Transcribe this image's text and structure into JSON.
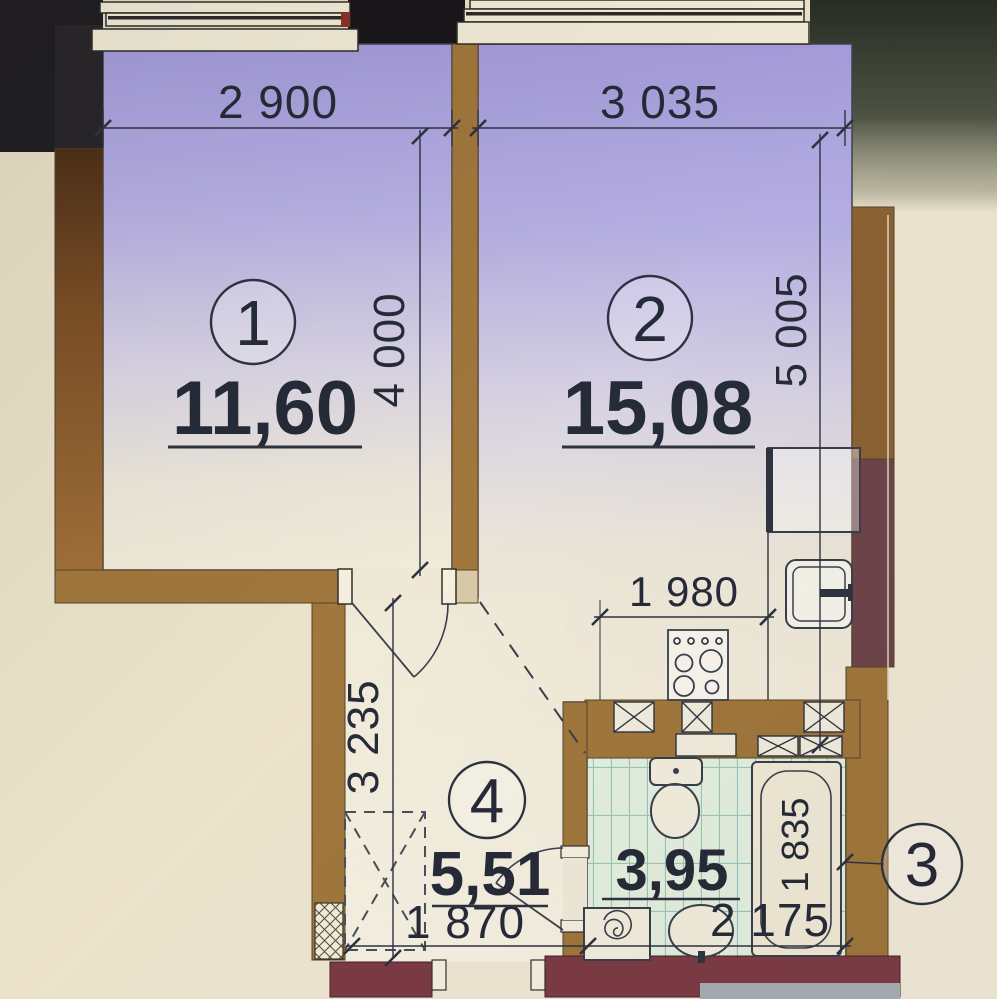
{
  "plan": {
    "rooms": [
      {
        "number": "1",
        "area": "11,60"
      },
      {
        "number": "2",
        "area": "15,08"
      },
      {
        "number": "3",
        "area": "3,95"
      },
      {
        "number": "4",
        "area": "5,51"
      }
    ],
    "dimensions": {
      "room1_width": "2 900",
      "room2_width": "3 035",
      "room1_depth": "4 000",
      "room2_depth": "5 005",
      "kitchen_run": "1 980",
      "hall_depth": "3 235",
      "hall_width": "1 870",
      "bath_length": "1 835",
      "bath_width": "2 175"
    },
    "colors": {
      "floor_purple": "#a59cda",
      "floor_cream": "#f0e9d8",
      "bath_tile": "#e3efdf",
      "wall_brown": "#a0773c",
      "wall_maroon": "#7c3b45",
      "wall_dark": "#211f22",
      "line": "#343a45",
      "text": "#262b38"
    }
  }
}
